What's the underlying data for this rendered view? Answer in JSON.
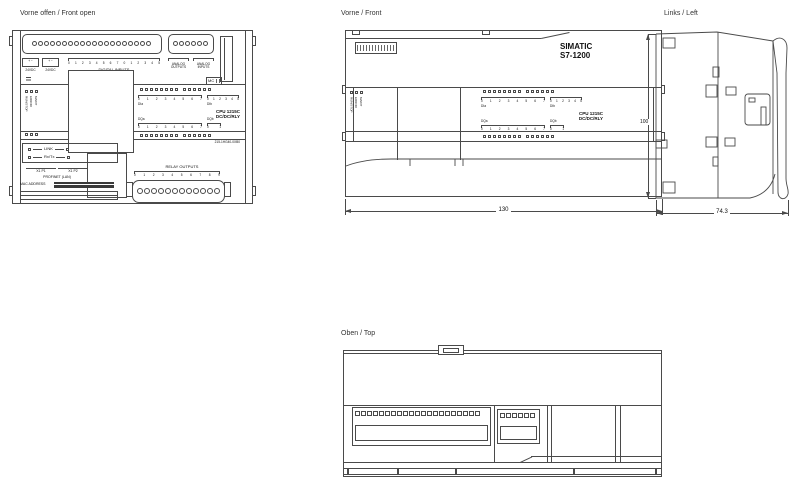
{
  "titles": {
    "front_open": "Vorne offen / Front open",
    "front": "Vorne / Front",
    "left": "Links / Left",
    "top": "Oben / Top"
  },
  "shared": {
    "status_leds": [
      "RUN/STOP",
      "ERROR",
      "MAINT"
    ],
    "dia_label": "DIa",
    "dib_label": "DIb",
    "dqa_label": "DQa",
    "dqb_label": "DQb",
    "dia_ticks": [
      "0",
      "1",
      "2",
      "3",
      "4",
      "5",
      "6",
      "7"
    ],
    "dib_ticks": [
      "0",
      "1",
      "2",
      "3",
      "4",
      "5"
    ],
    "dqa_ticks": [
      "0",
      "1",
      "2",
      "3",
      "4",
      "5",
      "6",
      "7"
    ],
    "dqb_ticks": [
      "0",
      "1"
    ],
    "cpu_model": "CPU 1215C",
    "cpu_type": "DC/DC/RLY",
    "led_group_a": 8,
    "led_group_b": 6,
    "status_led_count": 3
  },
  "front_open": {
    "power_label_1": "24VDC",
    "power_label_2": "24VDC",
    "power_marks": "+  −",
    "digital_inputs_label": "DIGITAL INPUTS",
    "di_terminal_ticks": [
      "0",
      "1",
      "2",
      "3",
      "4",
      "5",
      "6",
      "7",
      "0",
      "1",
      "2",
      "3",
      "4",
      "5"
    ],
    "analog_outputs_label": "ANALOG OUTPUTS",
    "analog_inputs_label": "ANALOG INPUTS",
    "mc_label": "MC",
    "terminal_main": 20,
    "terminal_aux": 6,
    "link_label": "LINK",
    "rxtx_label": "Rx/Tx",
    "port1_label": "X1 P1",
    "port2_label": "X1 P2",
    "profinet_label": "PROFINET (LAN)",
    "mac_label": "MAC ADDRESS",
    "relay_label": "RELAY OUTPUTS",
    "relay_ticks": [
      "0",
      "1",
      "2",
      "3",
      "4",
      "5",
      "6",
      "7",
      "8",
      "9"
    ],
    "relay_terminal_count": 12,
    "order_number": "215-1HG40-0XB0"
  },
  "front": {
    "brand_line1": "SIMATIC",
    "brand_line2": "S7-1200",
    "width_dimension": "130"
  },
  "left_view": {
    "height_dimension": "100",
    "depth_dimension": "74.3"
  },
  "top_view": {
    "terminals_main": 21,
    "terminals_aux": 6
  }
}
